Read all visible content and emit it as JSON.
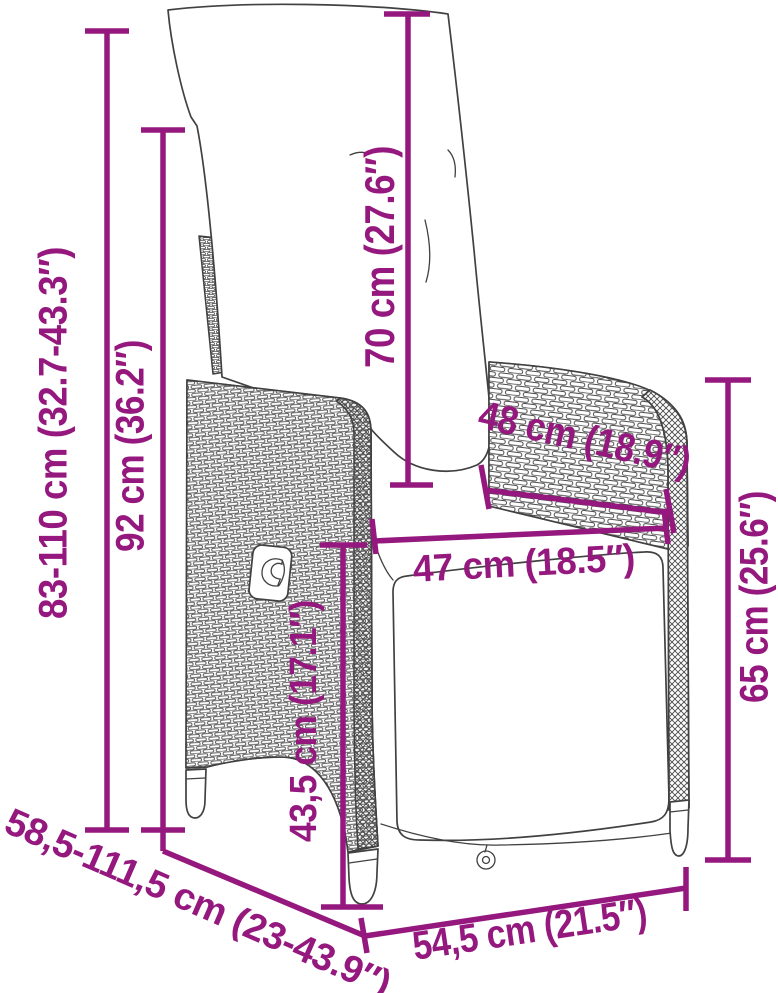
{
  "colors": {
    "accent": "#95187E",
    "line": "#414141"
  },
  "figure": {
    "subject": "Reclining garden chair with cushions — dimension diagram"
  },
  "dimensions": {
    "total_height": "83-110 cm (32.7-43.3″)",
    "backrest_height": "92 cm (36.2″)",
    "back_cushion_height": "70 cm (27.6″)",
    "seat_width_rear": "48 cm (18.9″)",
    "seat_width": "47 cm (18.5″)",
    "seat_height": "43,5 cm (17.1″)",
    "armrest_height": "65 cm (25.6″)",
    "seat_depth": "54,5 cm (21.5″)",
    "total_depth": "58,5-111,5 cm (23-43.9″)"
  }
}
